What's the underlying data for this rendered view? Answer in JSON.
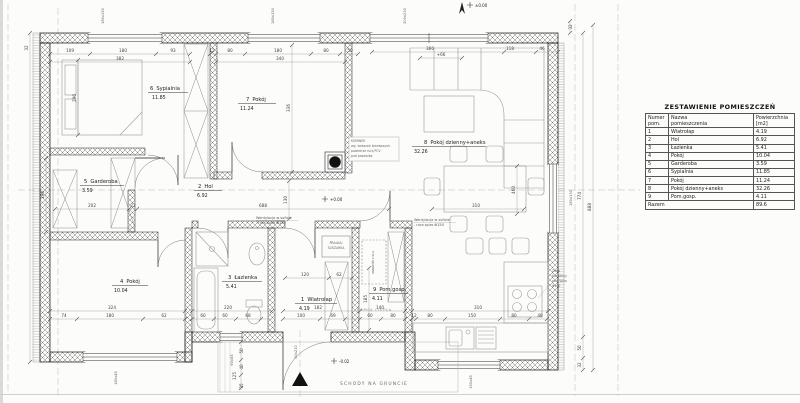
{
  "schedule": {
    "title": "ZESTAWIENIE POMIESZCZEŃ",
    "col_num_1": "Numer",
    "col_num_2": "pom.",
    "col_name_1": "Nazwa",
    "col_name_2": "pomieszczenia",
    "col_area_1": "Powierzchnia",
    "col_area_2": "[m2]",
    "total_label": "Razem",
    "total_value": "89.6"
  },
  "rooms": [
    {
      "num": "1",
      "name": "Wiatrołap",
      "area": "4.19"
    },
    {
      "num": "2",
      "name": "Hol",
      "area": "6.92"
    },
    {
      "num": "3",
      "name": "Łazienka",
      "area": "5.41"
    },
    {
      "num": "4",
      "name": "Pokój",
      "area": "10.04"
    },
    {
      "num": "5",
      "name": "Garderoba",
      "area": "3.59"
    },
    {
      "num": "6",
      "name": "Sypialnia",
      "area": "11.85"
    },
    {
      "num": "7",
      "name": "Pokój",
      "area": "11.24"
    },
    {
      "num": "8",
      "name": "Pokój dzienny+aneks",
      "area": "32.26"
    },
    {
      "num": "9",
      "name": "Pom.gosp.",
      "area": "4.11"
    }
  ],
  "annotations": {
    "schody": "SCHODY NA GRUNCIE",
    "pompa_ciepla": "POMPA CIEPŁA",
    "pralka_1": "PRALKA/",
    "pralka_2": "SUSZARKA",
    "went_1": "Wentylacja w suficie",
    "went_2": "- rura spiro Φ150",
    "okap_1": "Okap",
    "okap_2": "kuchenny",
    "okap_3": "rura spiro",
    "okap_4": "Φ150",
    "kominek_1": "KOMINEK",
    "kominek_2": "wg. wskazań branżowych",
    "kominek_3": "powietrze rurą PCV",
    "kominek_4": "pod posadzką",
    "zasobnik": "zasobnik c.w.u.",
    "level_hol": "+0.00",
    "level_top": "±0.00",
    "level_porch": "-0.02"
  },
  "openings": [
    "180x150",
    "180x150",
    "300x230",
    "180x130",
    "180x45",
    "60x45",
    "150x45",
    "90x210"
  ],
  "dims": [
    "109",
    "180",
    "93",
    "382",
    "12",
    "80",
    "180",
    "80",
    "50",
    "340",
    "360",
    "+66",
    "118",
    "46",
    "32",
    "774",
    "888",
    "50",
    "32",
    "32",
    "290",
    "336",
    "130",
    "196",
    "460",
    "185",
    "688",
    "202",
    "22",
    "324",
    "74",
    "180",
    "62",
    "220",
    "60",
    "60",
    "68",
    "120",
    "62",
    "182",
    "100",
    "69",
    "140",
    "60",
    "80",
    "310",
    "12",
    "80",
    "150",
    "80",
    "48",
    "310",
    "50",
    "40",
    "125",
    "35"
  ]
}
